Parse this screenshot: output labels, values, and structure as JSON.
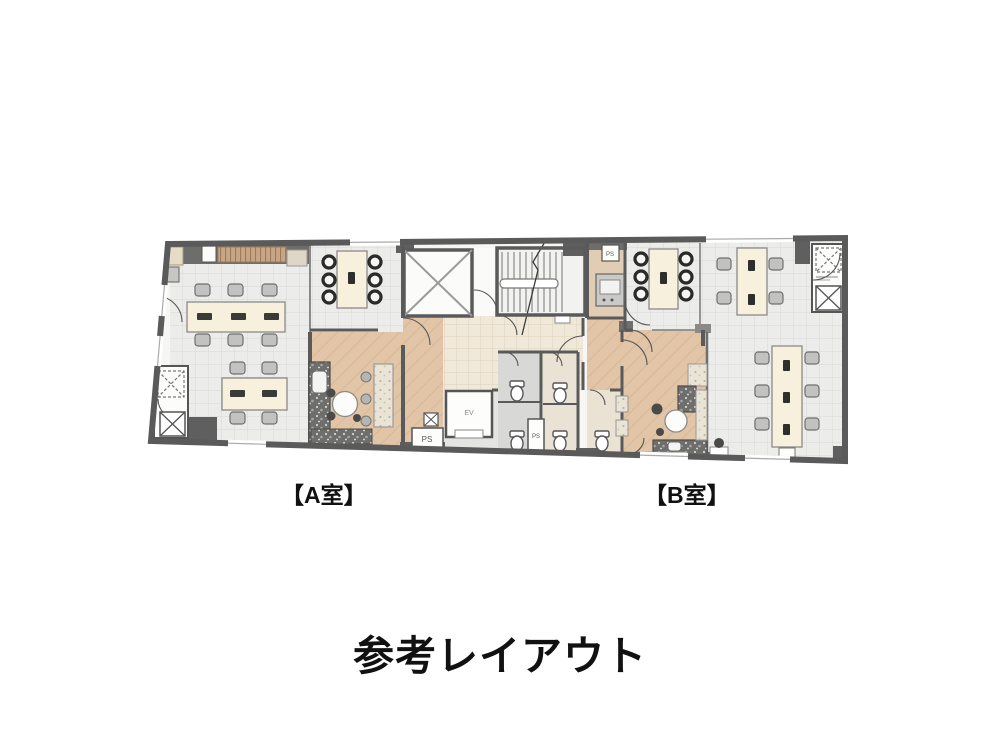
{
  "page": {
    "caption": "参考レイアウト"
  },
  "floorplan": {
    "room_a_label": "【A室】",
    "room_b_label": "【B室】",
    "annotations": {
      "elevator_car": "EV",
      "pipe_shaft": "PS"
    },
    "colors": {
      "wall": "#5a5a5a",
      "tile_floor": "#ececea",
      "entrance_tile_floor": "#f0e9da",
      "wood_floor": "#e2c5a7",
      "furniture_cream": "#f6f0dd",
      "counter_granite": "#6e6e6c",
      "label_text": "#111111"
    }
  }
}
